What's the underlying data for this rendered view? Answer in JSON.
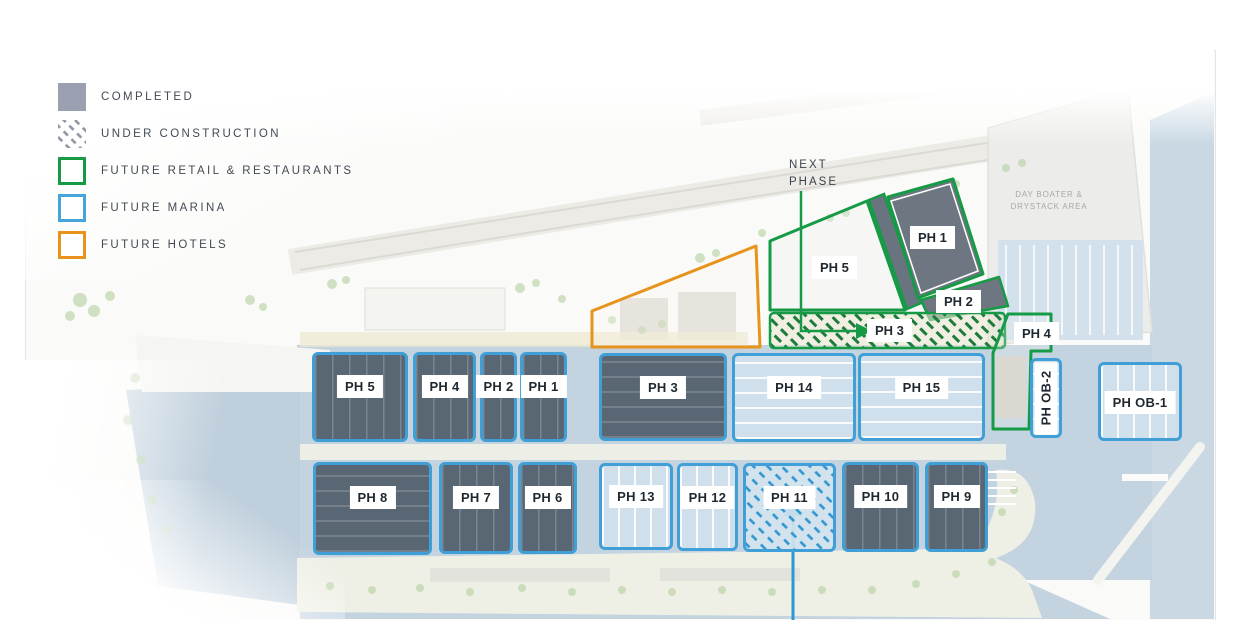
{
  "legend": {
    "items": [
      {
        "label": "COMPLETED",
        "status": "completed",
        "swatch": "gray-filled-square",
        "color": "#9aa0af"
      },
      {
        "label": "UNDER CONSTRUCTION",
        "status": "under-construction",
        "swatch": "diagonal-hatch-square",
        "color": "#8f95a3"
      },
      {
        "label": "FUTURE RETAIL & RESTAURANTS",
        "status": "future-retail-restaurants",
        "swatch": "green-outline-square",
        "color": "#169a46"
      },
      {
        "label": "FUTURE MARINA",
        "status": "future-marina",
        "swatch": "blue-outline-square",
        "color": "#45a5d9"
      },
      {
        "label": "FUTURE HOTELS",
        "status": "future-hotels",
        "swatch": "orange-outline-square",
        "color": "#e8931c"
      }
    ]
  },
  "annotations": {
    "next_phase_label": "NEXT PHASE",
    "next_phase_points_to": "PH 3",
    "under_construction_arrow_points_to": "PH 11",
    "area_label": "DAY BOATER & DRYSTACK AREA"
  },
  "phases": {
    "upland": [
      {
        "label": "PH 5",
        "status": "future-retail-restaurants"
      },
      {
        "label": "PH 1",
        "status": "completed-retail"
      },
      {
        "label": "PH 2",
        "status": "completed-retail"
      },
      {
        "label": "PH 3",
        "status": "under-construction-retail"
      },
      {
        "label": "PH 4",
        "status": "future-retail-restaurants"
      }
    ],
    "marina_row_1": [
      {
        "label": "PH 5",
        "status": "completed-marina"
      },
      {
        "label": "PH 4",
        "status": "completed-marina"
      },
      {
        "label": "PH 2",
        "status": "completed-marina"
      },
      {
        "label": "PH 1",
        "status": "completed-marina"
      },
      {
        "label": "PH 3",
        "status": "completed-marina"
      },
      {
        "label": "PH 14",
        "status": "future-marina"
      },
      {
        "label": "PH 15",
        "status": "future-marina"
      },
      {
        "label": "PH OB-2",
        "status": "future-marina"
      },
      {
        "label": "PH OB-1",
        "status": "future-marina"
      }
    ],
    "marina_row_2": [
      {
        "label": "PH 8",
        "status": "completed-marina"
      },
      {
        "label": "PH 7",
        "status": "completed-marina"
      },
      {
        "label": "PH 6",
        "status": "completed-marina"
      },
      {
        "label": "PH 13",
        "status": "future-marina"
      },
      {
        "label": "PH 12",
        "status": "future-marina"
      },
      {
        "label": "PH 11",
        "status": "under-construction-marina"
      },
      {
        "label": "PH 10",
        "status": "completed-marina"
      },
      {
        "label": "PH 9",
        "status": "completed-marina"
      }
    ]
  },
  "colors": {
    "completed_fill": "#9aa0af",
    "dock_dark_fill": "#596774",
    "marina_outline_blue": "#3f9fd6",
    "marina_light_fill": "#cfdfeb",
    "retail_green": "#169a46",
    "hotel_orange": "#e8931c",
    "hatch_blue": "#2f96d1",
    "hatch_green": "#1d7c3c",
    "water": "#c6d6e2",
    "text": "#434a54"
  }
}
